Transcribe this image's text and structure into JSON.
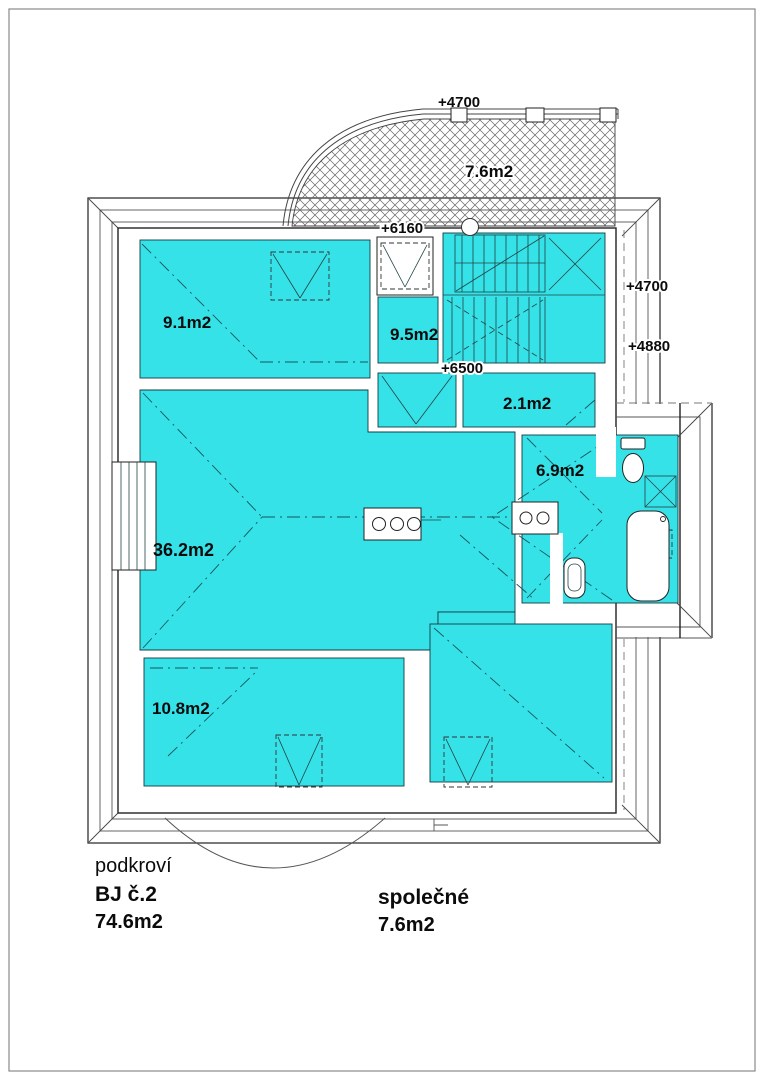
{
  "plan": {
    "colors": {
      "room_fill": "#35e2e8",
      "line": "#333333"
    },
    "labels": {
      "balcony_area": "7.6m2",
      "elev_balcony": "+4700",
      "elev_landing": "+6160",
      "elev_stair": "+6500",
      "elev_right_upper": "+4700",
      "elev_right_lower": "+4880",
      "room_9_1": "9.1m2",
      "room_9_5": "9.5m2",
      "room_2_1": "2.1m2",
      "room_6_9": "6.9m2",
      "room_36_2": "36.2m2",
      "room_10_8": "10.8m2"
    },
    "legend": {
      "floor": "podkroví",
      "unit": "BJ č.2",
      "unit_area": "74.6m2",
      "common": "společné",
      "common_area": "7.6m2"
    }
  }
}
